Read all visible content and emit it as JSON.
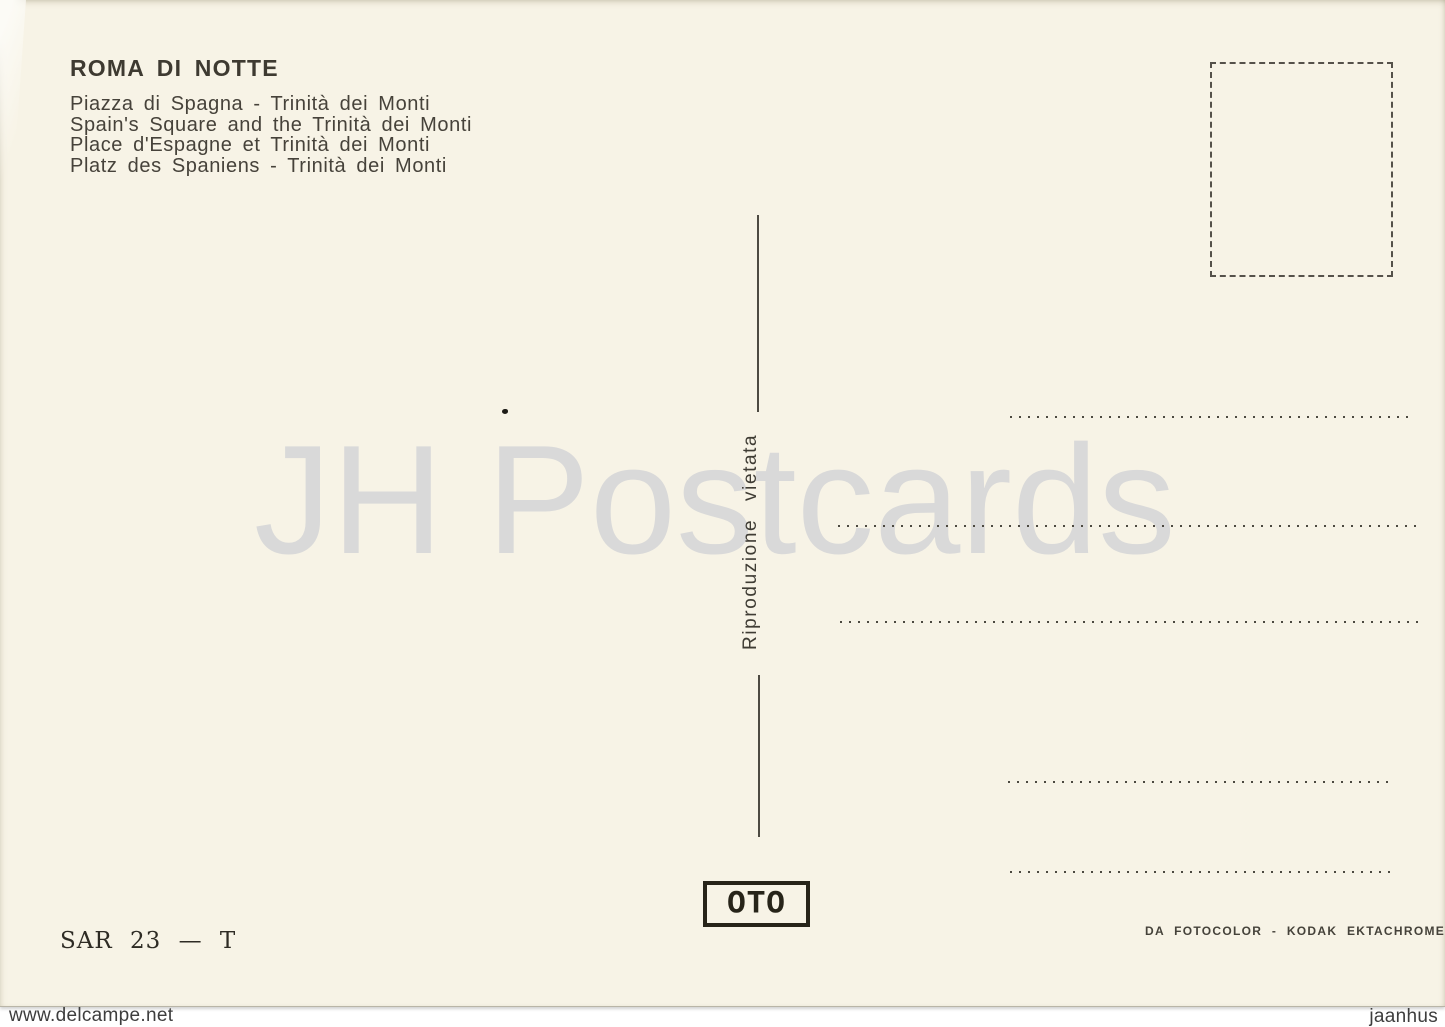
{
  "card": {
    "title": "ROMA DI NOTTE",
    "captions": [
      "Piazza di Spagna - Trinità dei Monti",
      "Spain's Square and the Trinità dei Monti",
      "Place d'Espagne et Trinità dei Monti",
      "Platz des Spaniens - Trinità dei Monti"
    ],
    "reproduction_notice": "Riproduzione vietata",
    "publisher_logo": "OTO",
    "serial": "SAR 23 — T",
    "film_credit": "DA FOTOCOLOR - KODAK EKTACHROME"
  },
  "watermarks": {
    "center": "JH Postcards",
    "bottom_left": "www.delcampe.net",
    "bottom_right": "jaanhus"
  },
  "colors": {
    "card_bg": "#f7f3e6",
    "ink": "#3e3a31",
    "watermark_gray": "#d9d9d9",
    "page_bg": "#ffffff"
  }
}
